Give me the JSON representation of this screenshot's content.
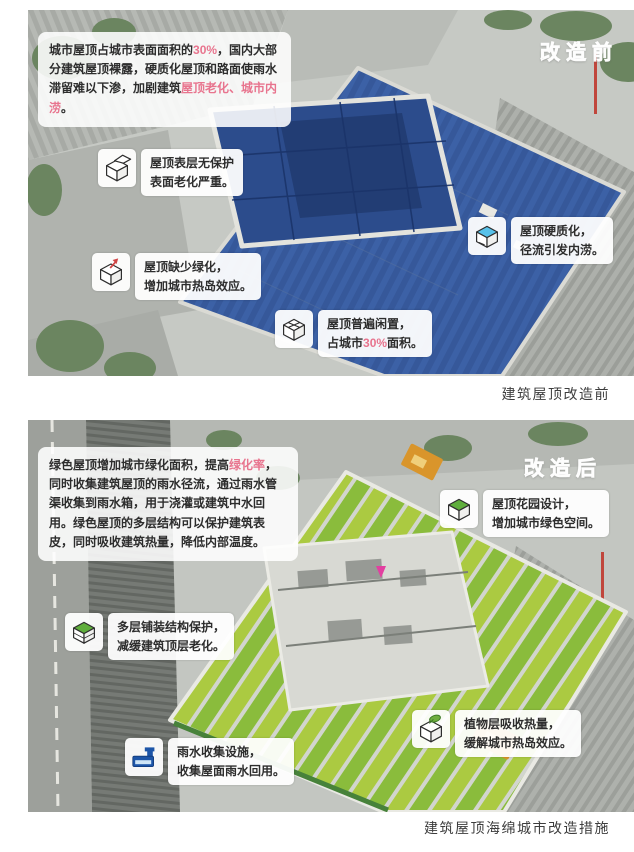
{
  "colors": {
    "highlight_pink": "#e8748e",
    "roof_blue": "#3a5ea2",
    "roof_green": "#8abc3c",
    "tank_blue": "#1d55a8",
    "seating_orange": "#d9952b"
  },
  "before": {
    "label": "改造前",
    "caption": "建筑屋顶改造前",
    "intro": {
      "p1": "城市屋顶占城市表面面积的",
      "h1": "30%",
      "p2": "，国内大部分建筑屋顶裸露，硬质化屋顶和路面使雨水滞留难以下渗，加剧建筑",
      "h2": "屋顶老化、城市内涝",
      "p3": "。"
    },
    "callouts": {
      "surface": {
        "icon": "peeled-surface-cube-icon",
        "line1": "屋顶表层无保护",
        "line2": "表面老化严重。"
      },
      "hardened": {
        "icon": "hardened-roof-water-cube-icon",
        "line1": "屋顶硬质化，",
        "line2": "径流引发内涝。"
      },
      "nogreen": {
        "icon": "heat-island-arrow-cube-icon",
        "line1": "屋顶缺少绿化，",
        "line2": "增加城市热岛效应。"
      },
      "idle": {
        "icon": "idle-roof-crossed-cube-icon",
        "line1": "屋顶普遍闲置，",
        "line2_pre": "占城市",
        "line2_hl": "30%",
        "line2_post": "面积。"
      }
    }
  },
  "after": {
    "label": "改造后",
    "caption": "建筑屋顶海绵城市改造措施",
    "intro": {
      "p1": "绿色屋顶增加城市绿化面积，提高",
      "h1": "绿化率",
      "p2": "，同时收集建筑屋顶的雨水径流，通过雨水管渠收集到雨水箱，用于浇灌或建筑中水回用。绿色屋顶的多层结构可以保护建筑表皮，同时吸收建筑热量，降低内部温度。"
    },
    "callouts": {
      "garden": {
        "icon": "green-roof-cube-icon",
        "line1": "屋顶花园设计，",
        "line2": "增加城市绿色空间。"
      },
      "layers": {
        "icon": "layered-paving-cube-icon",
        "line1": "多层铺装结构保护，",
        "line2": "减缓建筑顶层老化。"
      },
      "rain": {
        "icon": "rainwater-tank-icon",
        "line1": "雨水收集设施，",
        "line2": "收集屋面雨水回用。"
      },
      "plants": {
        "icon": "plant-layer-leaf-cube-icon",
        "line1": "植物层吸收热量，",
        "line2": "缓解城市热岛效应。"
      }
    }
  }
}
